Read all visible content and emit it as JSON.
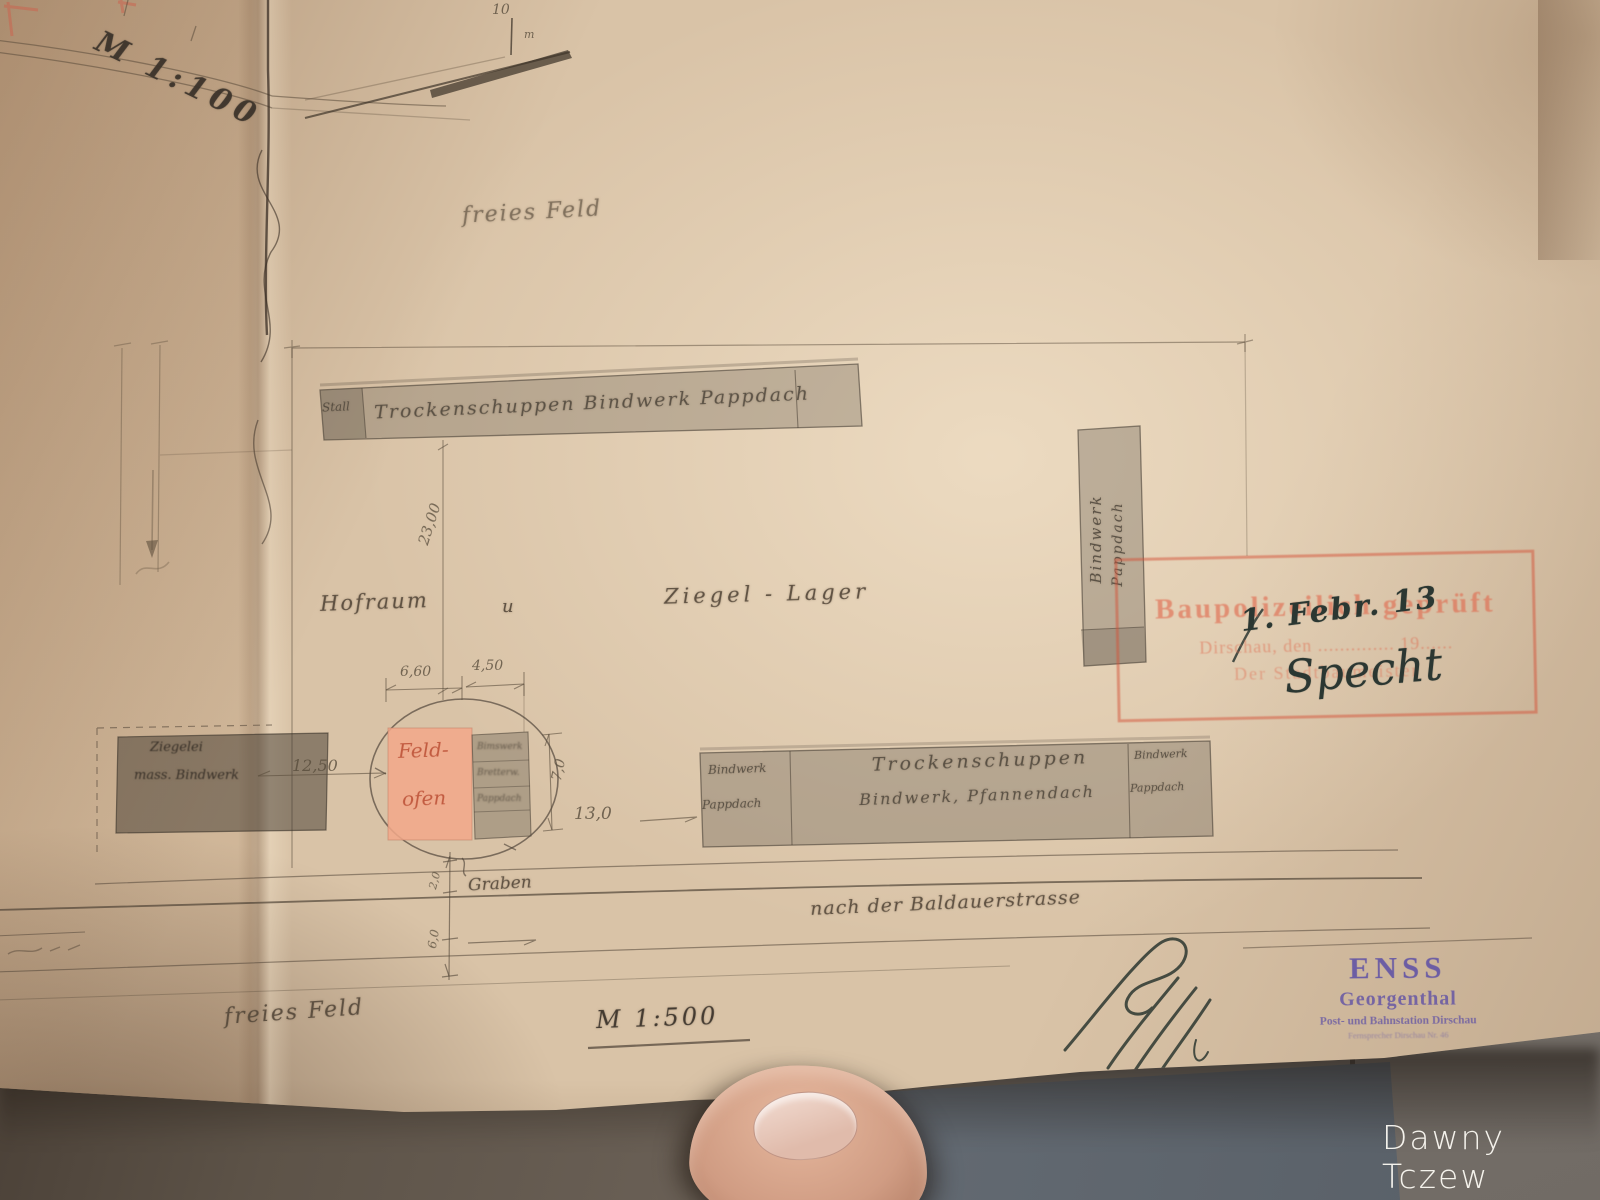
{
  "watermark": "Dawny Tczew",
  "plan": {
    "scale_top": "M 1:100",
    "scale_bottom": "M 1:500",
    "scale_bar": {
      "ten": "10",
      "unit": "m"
    },
    "labels": {
      "freies_feld_top": "freies Feld",
      "freies_feld_bottom": "freies Feld",
      "hofraum": "Hofraum",
      "und": "u",
      "ziegel_lager": "Ziegel - Lager",
      "graben": "Graben",
      "strasse": "nach der Baldauerstrasse"
    },
    "buildings": {
      "top_strip_cell": "Stall",
      "top_strip": "Trockenschuppen Bindwerk Pappdach",
      "right_vertical_line1": "Bindwerk",
      "right_vertical_line2": "Pappdach",
      "bottom_left_line1": "Bindwerk",
      "bottom_left_line2": "Pappdach",
      "bottom_mid_line1": "Trockenschuppen",
      "bottom_mid_line2": "Bindwerk, Pfannendach",
      "bottom_right_line1": "Bindwerk",
      "bottom_right_line2": "Pappdach",
      "feldofen_line1": "Feld-",
      "feldofen_line2": "ofen",
      "annex_line1": "Bimswerk",
      "annex_line2": "Bretterw.",
      "annex_line3": "Pappdach",
      "left_building_line1": "Ziegelei",
      "left_building_line2": "mass. Bindwerk"
    },
    "dimensions": {
      "d23": "23,00",
      "d660": "6,60",
      "d450": "4,50",
      "d70": "7,0",
      "d1250": "12,50",
      "d130": "13,0",
      "d20": "2,0",
      "d60": "6,0"
    }
  },
  "stamps": {
    "red": {
      "line1": "Baupolizeilich geprüft",
      "line2": "Dirschau, den .............. 19......",
      "line3": "Der Stadtbaumeister"
    },
    "purple": {
      "line1": "ENSS",
      "line2": "Georgenthal",
      "line3": "Post- und Bahnstation Dirschau",
      "line4": "Fernsprecher Dirschau Nr. 46"
    }
  },
  "ink": {
    "date": "1. Febr. 13",
    "signature_name": "Specht"
  }
}
